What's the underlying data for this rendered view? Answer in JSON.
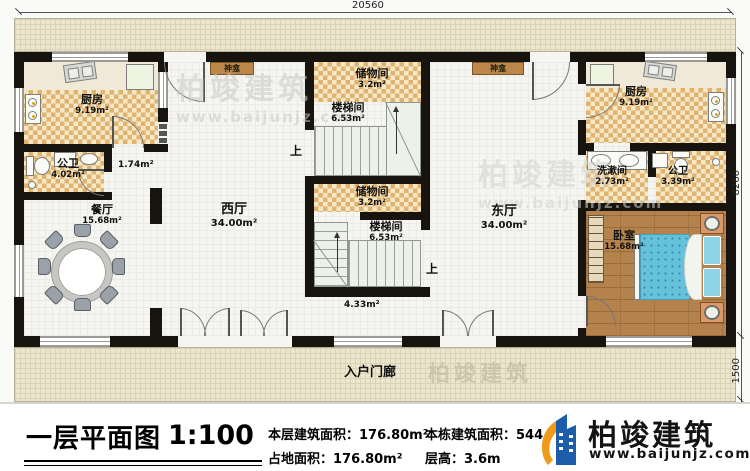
{
  "plan": {
    "dimensions": {
      "width_total": "20560",
      "height_main": "8260",
      "height_porch": "1500"
    },
    "up_label": "上",
    "porch": {
      "name": "入户门廊"
    },
    "rooms": {
      "kitchen": {
        "name": "厨房",
        "area": "9.19m²"
      },
      "bath_left": {
        "name": "公卫",
        "area": "4.02m²"
      },
      "corridor_small": {
        "area": "1.74m²"
      },
      "dining": {
        "name": "餐厅",
        "area": "15.68m²"
      },
      "west_hall": {
        "name": "西厅",
        "area": "34.00m²"
      },
      "east_hall": {
        "name": "东厅",
        "area": "34.00m²"
      },
      "shrine": {
        "name": "神龛"
      },
      "storage": {
        "name": "储物间",
        "area": "3.2m²"
      },
      "stairwell": {
        "name": "楼梯间",
        "area": "6.53m²"
      },
      "center_corridor": {
        "area": "4.33m²"
      },
      "washroom": {
        "name": "洗漱间",
        "area": "2.73m²"
      },
      "bath_right": {
        "name": "公卫",
        "area": "3.39m²"
      },
      "bedroom": {
        "name": "卧室",
        "area": "15.68m²"
      }
    }
  },
  "watermark": {
    "brand": "柏竣建筑",
    "url": "www.baijunjz.com"
  },
  "footer": {
    "title": "一层平面图",
    "scale": "1:100",
    "stats": {
      "floor_area": "本层建筑面积：176.80m²",
      "site_area": "占地面积：176.80m²",
      "total_area": "本栋建筑面积：544",
      "floor_height": "层高：3.6m"
    },
    "brand": "柏竣建筑",
    "website": "www.baijunjz.com"
  },
  "colors": {
    "wall": "#17130e",
    "tile_dark": "#dfb372",
    "tile_light": "#f6e8c4",
    "bed": "#66c2db",
    "brand_blue": "#1c5ca8",
    "brand_orange": "#f09a1c"
  }
}
